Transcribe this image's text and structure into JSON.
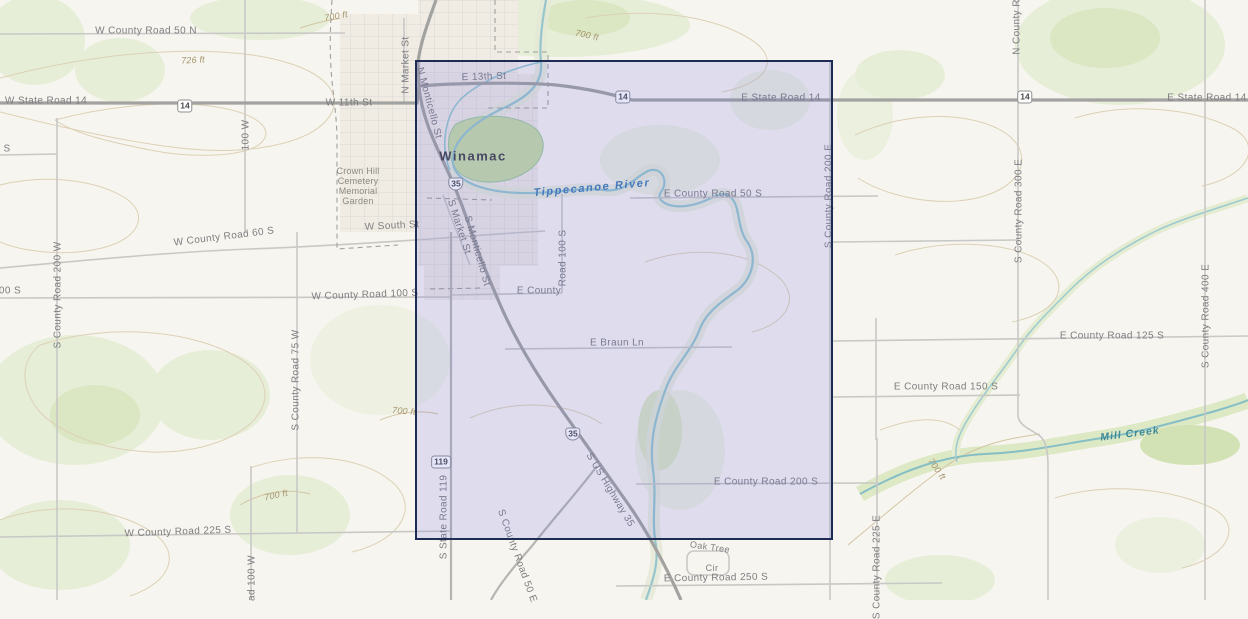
{
  "town": {
    "name": "Winamac"
  },
  "water": {
    "river": "Tippecanoe River",
    "creek": "Mill Creek"
  },
  "shields": {
    "route14": "14",
    "route35": "35",
    "route119": "119"
  },
  "elevations": {
    "e726": "726 ft",
    "e700": "700 ft"
  },
  "poi": {
    "cemetery_line1": "Crown Hill",
    "cemetery_line2": "Cemetery",
    "cemetery_line3": "Memorial",
    "cemetery_line4": "Garden",
    "oak_tree": "Oak Tree",
    "cir": "Cir"
  },
  "roads": {
    "wCountyRoad50N": "W County Road 50 N",
    "wStateRoad14": "W State Road 14",
    "w11thSt": "W 11th St",
    "e13thSt": "E 13th St",
    "eStateRoad14": "E State Road 14",
    "eCountyRoad50S": "E County Road 50 S",
    "eCounty": "E County",
    "road100S": "Road 100 S",
    "eBraunLn": "E Braun Ln",
    "eCountyRoad200S": "E County Road 200 S",
    "eCountyRoad250S": "E County Road 250 S",
    "eCountyRoad150S": "E County Road 150 S",
    "eCountyRoad125S": "E County Road 125 S",
    "wCountyRoad60S": "W County Road 60 S",
    "wSouthSt": "W South St",
    "wCountyRoad100S": "W County Road 100 S",
    "wCountyRoad225S": "W County Road 225 S",
    "partial00S": "00 S",
    "partialS": "S",
    "partial100W": "100 W",
    "partialAd100W": "ad 100 W",
    "nCountyRoPartial": "N County Ro",
    "nMarketSt": "N Market St",
    "sMarketSt": "S Market St",
    "nMonticelloSt": "N Monticello St",
    "sMonticelloSt": "S Monticello St",
    "sCountyRoad200W": "S County Road 200 W",
    "sCountyRoad75W": "S County Road 75 W",
    "sStateRoad119": "S State Road 119",
    "sUsHighway35": "S US Highway 35",
    "sCountyRoad50E": "S County Road 50 E",
    "sCountyRoad200E": "S County Road 200 E",
    "sCountyRoad225E": "S County Road 225 E",
    "sCountyRoad300E": "S County Road 300 E",
    "sCountyRoad400E": "S County Road 400 E"
  },
  "colors": {
    "background": "#f7f5ef",
    "selectionFill": "rgba(100,100,230,0.16)",
    "selectionBorder": "#1e2b52",
    "waterStroke": "#96c6cc",
    "waterLabel": "#3f7db2",
    "creekLabel": "#3d8a96",
    "roadLabel": "#7d7d80",
    "contour": "#dcd1b6",
    "vegetation": "#e7eed8"
  }
}
